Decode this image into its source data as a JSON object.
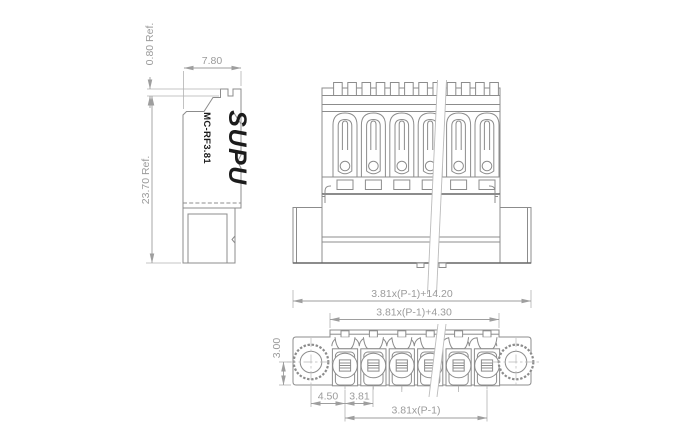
{
  "product": {
    "brand": "SUPU",
    "model": "MC-RF3.81"
  },
  "side_view": {
    "dim_ref_top": "0.80 Ref.",
    "dim_width": "7.80",
    "dim_height": "23.70 Ref."
  },
  "bottom_view": {
    "dim_overall": "3.81x(P-1)+14.20",
    "dim_inner": "3.81x(P-1)+4.30",
    "dim_flange_height": "3.00",
    "dim_first_pole_offset": "4.50",
    "dim_pitch": "3.81",
    "dim_span": "3.81x(P-1)"
  },
  "colors": {
    "outline": "#8c8c8c",
    "outline_dark": "#666666",
    "dimension": "#9e9e9e",
    "dimension_text": "#9b9b9b",
    "brand_text": "#1c1c1c",
    "hatch_line": "#8f8f8f",
    "hatch_bg": "#efefef",
    "background": "#ffffff"
  }
}
